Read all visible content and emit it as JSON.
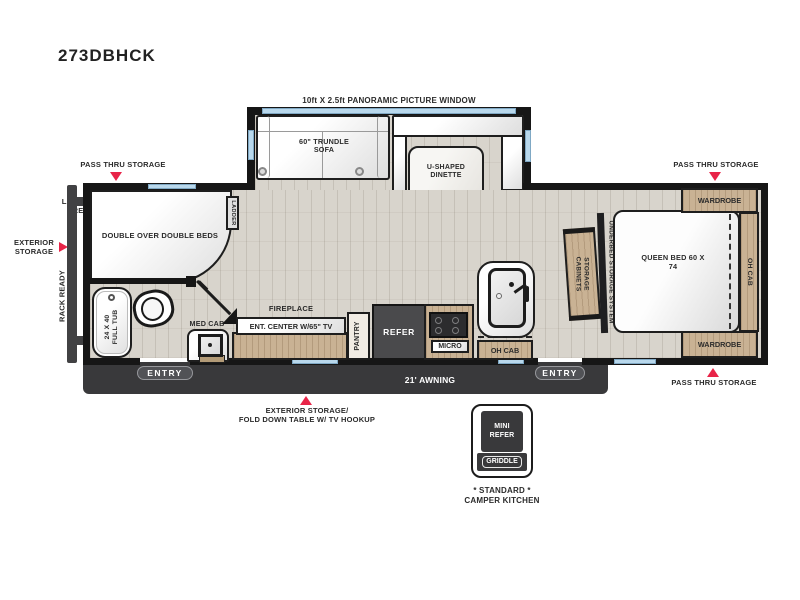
{
  "page": {
    "title": "273DBHCK"
  },
  "exterior": {
    "panoramic_window": "10ft X 2.5ft PANORAMIC PICTURE WINDOW",
    "pass_thru_left": "PASS THRU STORAGE",
    "pass_thru_right_top": "PASS THRU STORAGE",
    "pass_thru_right_bottom": "PASS THRU STORAGE",
    "ladder_prep": "LADDER PREP",
    "exterior_storage": "EXTERIOR STORAGE",
    "rack_ready": "RACK READY",
    "fold_down_line1": "EXTERIOR STORAGE/",
    "fold_down_line2": "FOLD DOWN TABLE W/ TV HOOKUP",
    "awning": "21' AWNING",
    "entry_front": "ENTRY",
    "entry_rear": "ENTRY"
  },
  "living": {
    "trundle_sofa": "60\" TRUNDLE SOFA",
    "dinette": "U-SHAPED DINETTE",
    "fireplace": "FIREPLACE",
    "ent_center": "ENT. CENTER W/65\" TV",
    "pantry": "PANTRY",
    "refer": "REFER",
    "micro": "MICRO",
    "oh_cab": "OH CAB"
  },
  "bunk_bath": {
    "double_beds": "DOUBLE OVER DOUBLE BEDS",
    "ladder": "LADDER",
    "tub": "24 X 40 FULL TUB",
    "med_cab": "MED CAB"
  },
  "bedroom": {
    "queen_bed": "QUEEN BED 60 X 74",
    "wardrobe_top": "WARDROBE",
    "wardrobe_bottom": "WARDROBE",
    "oh_cab": "OH CAB",
    "storage_cabinets": "STORAGE CABINETS",
    "underbed_storage": "UNDERBED STORAGE SYSTEM"
  },
  "camper_kitchen": {
    "mini_refer": "MINI REFER",
    "griddle": "GRIDDLE",
    "caption_line1": "* STANDARD *",
    "caption_line2": "CAMPER KITCHEN"
  },
  "colors": {
    "accent_red": "#e82448",
    "window_blue": "#b9d8ec",
    "wall": "#161616",
    "wood_floor": "#d8d4cc",
    "cabinet_tan": "#c9b294",
    "appliance_dark": "#4a4a4c",
    "awning_band": "#39393b"
  }
}
